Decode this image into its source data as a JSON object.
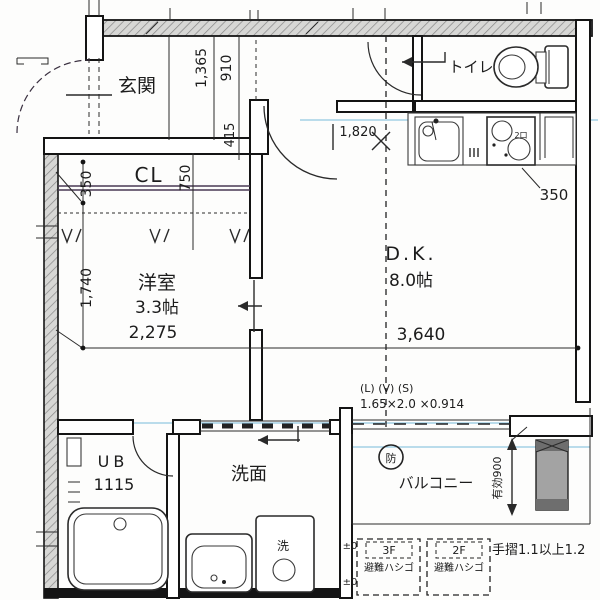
{
  "drawing": {
    "rooms": {
      "genkan": {
        "label": "玄関"
      },
      "toilet": {
        "label": "トイレ"
      },
      "closet": {
        "label": "CL"
      },
      "western_room": {
        "label": "洋室",
        "size": "3.3帖",
        "width": "2,275"
      },
      "dining_kitchen": {
        "label": "D.K.",
        "size": "8.0帖",
        "width": "3,640"
      },
      "unit_bath": {
        "label": "UB",
        "size": "1115"
      },
      "washroom": {
        "label": "洗面"
      },
      "balcony": {
        "label": "バルコニー"
      }
    },
    "dimensions": {
      "genkan_depth": "1,365",
      "genkan_910": "910",
      "genkan_415": "415",
      "closet_depth": "350",
      "closet_750": "750",
      "western_height": "1,740",
      "kitchen_width": "1,820",
      "kitchen_side": "350",
      "balcony_effective": "有効900"
    },
    "marks": {
      "fire_prevention": "防",
      "washer": "洗",
      "burners": "2口"
    },
    "annotations": {
      "lvs_heading": "(L) (V) (S)",
      "lvs_values": "1.65×2.0 ×0.914",
      "handrail_note": "手摺1.1以上1.2",
      "level_upper": "±0",
      "level_lower": "±0",
      "ladder_3f_floor": "3F",
      "ladder_3f_label": "避難ハシゴ",
      "ladder_2f_floor": "2F",
      "ladder_2f_label": "避難ハシゴ"
    }
  }
}
